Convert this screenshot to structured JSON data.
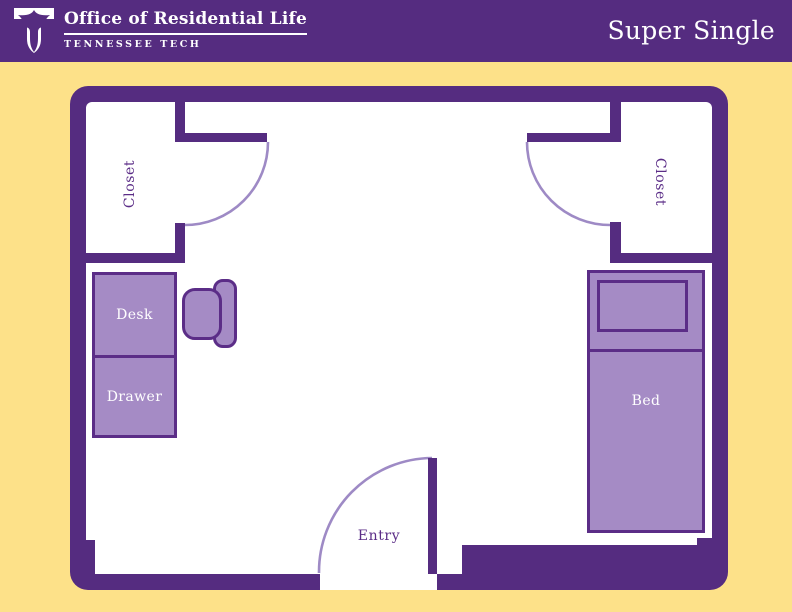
{
  "header": {
    "brand": "Office of Residential Life",
    "tagline": "TENNESSEE TECH",
    "title": "Super Single",
    "logo_icon": "tennessee-tech-eagle-logo"
  },
  "plan": {
    "labels": {
      "closet_left": "Closet",
      "closet_right": "Closet",
      "entry": "Entry",
      "desk": "Desk",
      "drawer": "Drawer",
      "bed": "Bed"
    }
  },
  "colors": {
    "purple": "#552c80",
    "background_yellow": "#fde189",
    "furniture_fill": "#a58bc5",
    "furniture_outline": "#5b2d87",
    "door_arc": "#9e8ac5",
    "label_light": "#ffffff",
    "label_dark": "#5b2d87"
  }
}
